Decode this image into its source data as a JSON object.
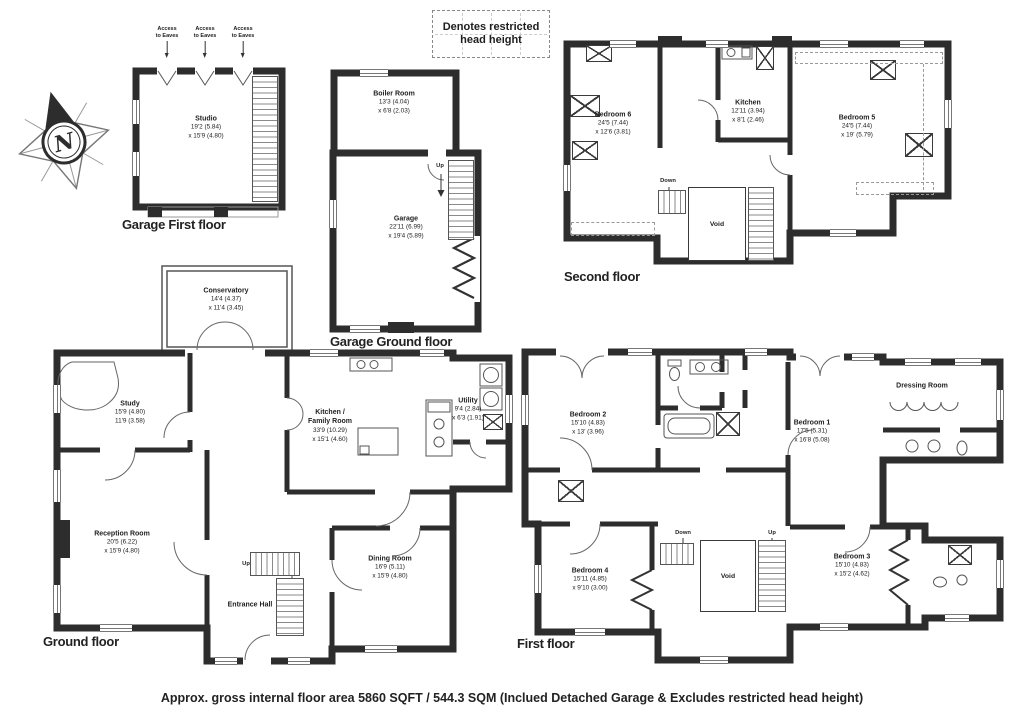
{
  "page": {
    "caption": "Approx. gross internal floor area 5860 SQFT / 544.3 SQM (Inclued Detached Garage & Excludes restricted head height)"
  },
  "legend": {
    "restricted_note": "Denotes restricted head height",
    "compass": "N",
    "access_eaves_line1": "Access",
    "access_eaves_line2": "to Eaves",
    "up": "Up",
    "down": "Down",
    "void": "Void"
  },
  "colors": {
    "wall": "#2d2d2d",
    "dashed_zone": "#9a9a9a",
    "text": "#1e1e1e"
  },
  "floors": {
    "garage_first": {
      "title": "Garage First floor"
    },
    "garage_ground": {
      "title": "Garage Ground floor"
    },
    "second": {
      "title": "Second floor"
    },
    "ground": {
      "title": "Ground floor"
    },
    "first": {
      "title": "First floor"
    }
  },
  "rooms": {
    "studio": {
      "name": "Studio",
      "d1": "19'2 (5.84)",
      "d2": "x 15'9 (4.80)"
    },
    "boiler_room": {
      "name": "Boiler Room",
      "d1": "13'3 (4.04)",
      "d2": "x 6'8 (2.03)"
    },
    "garage": {
      "name": "Garage",
      "d1": "22'11 (6.99)",
      "d2": "x 19'4 (5.89)"
    },
    "bedroom6": {
      "name": "Bedroom 6",
      "d1": "24'5 (7.44)",
      "d2": "x 12'6 (3.81)"
    },
    "kitchen_second": {
      "name": "Kitchen",
      "d1": "12'11 (3.94)",
      "d2": "x 8'1 (2.46)"
    },
    "bedroom5": {
      "name": "Bedroom 5",
      "d1": "24'5 (7.44)",
      "d2": "x 19' (5.79)"
    },
    "conservatory": {
      "name": "Conservatory",
      "d1": "14'4 (4.37)",
      "d2": "x 11'4 (3.45)"
    },
    "study": {
      "name": "Study",
      "d1": "15'9 (4.80)",
      "d2": "11'9 (3.58)"
    },
    "kitchen_family": {
      "name": "Kitchen /",
      "name2": "Family Room",
      "d1": "33'9 (10.29)",
      "d2": "x 15'1 (4.60)"
    },
    "utility": {
      "name": "Utility",
      "d1": "9'4 (2.84)",
      "d2": "x 6'3 (1.91)"
    },
    "reception": {
      "name": "Reception Room",
      "d1": "20'5 (6.22)",
      "d2": "x 15'9 (4.80)"
    },
    "dining": {
      "name": "Dining Room",
      "d1": "16'9 (5.11)",
      "d2": "x 15'9 (4.80)"
    },
    "entrance": {
      "name": "Entrance Hall"
    },
    "bedroom2": {
      "name": "Bedroom 2",
      "d1": "15'10 (4.83)",
      "d2": "x 13' (3.96)"
    },
    "bedroom1": {
      "name": "Bedroom 1",
      "d1": "17'5 (5.31)",
      "d2": "x 16'8 (5.08)"
    },
    "dressing": {
      "name": "Dressing Room"
    },
    "bedroom4": {
      "name": "Bedroom 4",
      "d1": "15'11 (4.85)",
      "d2": "x 9'10 (3.00)"
    },
    "bedroom3": {
      "name": "Bedroom 3",
      "d1": "15'10 (4.83)",
      "d2": "x 15'2 (4.62)"
    }
  }
}
